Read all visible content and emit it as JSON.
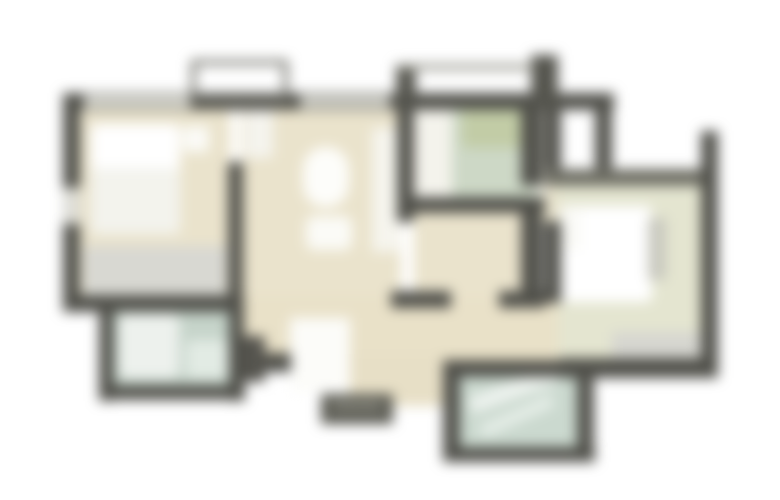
{
  "meta": {
    "description": "Blurred apartment floor plan, no readable text",
    "canvas": {
      "width": 780,
      "height": 500,
      "background": "#ffffff"
    },
    "blur_px": 6.5
  },
  "palette": {
    "wall_dark": "#50504a",
    "wall_light_window": "#d8d8d0",
    "floor_beige": "#eae3cc",
    "floor_pale_green": "#e4e5d0",
    "tile_green": "#cbd9cf",
    "shower_green": "#c2cca6",
    "furniture_white": "#ffffff",
    "furniture_gray": "#d8d8d2",
    "porch_gray": "#5a5a52"
  },
  "floorplan": {
    "rects": [
      {
        "name": "left-bedroom-floor",
        "x": 78,
        "y": 104,
        "w": 152,
        "h": 198,
        "fill": "#eae3cc"
      },
      {
        "name": "living-room-floor",
        "x": 241,
        "y": 104,
        "w": 160,
        "h": 256,
        "fill": "#eae3cc"
      },
      {
        "name": "hall-floor",
        "x": 241,
        "y": 296,
        "w": 380,
        "h": 64,
        "fill": "#e9e1c8"
      },
      {
        "name": "corridor-floor",
        "x": 414,
        "y": 212,
        "w": 112,
        "h": 86,
        "fill": "#eae3cc"
      },
      {
        "name": "right-door-opening-floor",
        "x": 540,
        "y": 186,
        "w": 22,
        "h": 38,
        "fill": "#e8e2cc"
      },
      {
        "name": "mid-bathroom-floor",
        "x": 414,
        "y": 106,
        "w": 130,
        "h": 100,
        "fill": "#f4f3ec"
      },
      {
        "name": "mid-bathroom-tiles",
        "x": 452,
        "y": 104,
        "w": 84,
        "h": 100,
        "fill": "#cdd8c6"
      },
      {
        "name": "mid-bathroom-shower",
        "x": 462,
        "y": 98,
        "w": 70,
        "h": 50,
        "fill": "#c2cca6",
        "radius": 6
      },
      {
        "name": "right-bedroom-floor",
        "x": 558,
        "y": 182,
        "w": 146,
        "h": 176,
        "fill": "#e4e5d0"
      },
      {
        "name": "left-bathroom-tiles",
        "x": 110,
        "y": 306,
        "w": 124,
        "h": 86,
        "fill": "#c6d4ca"
      },
      {
        "name": "bottom-bathroom-tiles",
        "x": 458,
        "y": 374,
        "w": 124,
        "h": 78,
        "fill": "#cbd9cf"
      },
      {
        "name": "vestibule-floor",
        "x": 348,
        "y": 354,
        "w": 102,
        "h": 52,
        "fill": "#e7dfc6"
      },
      {
        "name": "left-bed",
        "x": 91,
        "y": 124,
        "w": 89,
        "h": 110,
        "fill": "#ffffff",
        "radius": 6
      },
      {
        "name": "left-bed-blanket",
        "x": 91,
        "y": 168,
        "w": 89,
        "h": 66,
        "fill": "#f3f3ed",
        "radius": 4
      },
      {
        "name": "left-nightstand",
        "x": 183,
        "y": 126,
        "w": 26,
        "h": 26,
        "fill": "#fbfbf7"
      },
      {
        "name": "left-wardrobe",
        "x": 84,
        "y": 246,
        "w": 142,
        "h": 50,
        "fill": "#d8d8d2"
      },
      {
        "name": "living-table",
        "x": 303,
        "y": 147,
        "w": 46,
        "h": 60,
        "fill": "#fdfdfa",
        "radius": 22
      },
      {
        "name": "living-chair-group",
        "x": 306,
        "y": 216,
        "w": 46,
        "h": 34,
        "fill": "#fbfbf7",
        "radius": 8
      },
      {
        "name": "living-door-swing-white",
        "x": 245,
        "y": 106,
        "w": 28,
        "h": 52,
        "fill": "#f5f4ee"
      },
      {
        "name": "kitchen-counter-strip",
        "x": 372,
        "y": 128,
        "w": 28,
        "h": 124,
        "fill": "#f6f5ee"
      },
      {
        "name": "right-bed",
        "x": 560,
        "y": 206,
        "w": 92,
        "h": 96,
        "fill": "#ffffff",
        "radius": 6
      },
      {
        "name": "right-bed-pillow",
        "x": 561,
        "y": 210,
        "w": 20,
        "h": 40,
        "fill": "#fafaf6"
      },
      {
        "name": "right-bedside-unit",
        "x": 648,
        "y": 218,
        "w": 18,
        "h": 62,
        "fill": "#c9c9bf"
      },
      {
        "name": "right-wardrobe",
        "x": 612,
        "y": 332,
        "w": 92,
        "h": 28,
        "fill": "#d6d6d0"
      },
      {
        "name": "left-bathtub",
        "x": 119,
        "y": 314,
        "w": 60,
        "h": 64,
        "fill": "#edf1ed",
        "radius": 8
      },
      {
        "name": "left-bathroom-sink",
        "x": 186,
        "y": 340,
        "w": 42,
        "h": 38,
        "fill": "#e2ebe4",
        "radius": 6
      },
      {
        "name": "bottom-bath-fixture-1",
        "x": 468,
        "y": 382,
        "w": 92,
        "h": 16,
        "fill": "#eef3ef",
        "rotate": -20
      },
      {
        "name": "bottom-bath-fixture-2",
        "x": 478,
        "y": 410,
        "w": 78,
        "h": 12,
        "fill": "#e7efe9",
        "rotate": -24
      },
      {
        "name": "entry-door-white",
        "x": 290,
        "y": 318,
        "w": 60,
        "h": 74,
        "fill": "#fcfcf9"
      },
      {
        "name": "top-wall",
        "x": 63,
        "y": 93,
        "w": 551,
        "h": 17,
        "fill": "#50504a"
      },
      {
        "name": "top-window-left",
        "x": 84,
        "y": 95,
        "w": 106,
        "h": 13,
        "fill": "#d8d8d0"
      },
      {
        "name": "top-window-mid",
        "x": 300,
        "y": 95,
        "w": 90,
        "h": 13,
        "fill": "#cfcfc7"
      },
      {
        "name": "left-outer-wall",
        "x": 63,
        "y": 93,
        "w": 17,
        "h": 219,
        "fill": "#50504a"
      },
      {
        "name": "left-wall-window",
        "x": 63,
        "y": 188,
        "w": 17,
        "h": 36,
        "fill": "#dcdcd6"
      },
      {
        "name": "left-bedroom-bottom-wall",
        "x": 63,
        "y": 295,
        "w": 181,
        "h": 17,
        "fill": "#50504a"
      },
      {
        "name": "bedroom-living-divider",
        "x": 228,
        "y": 162,
        "w": 15,
        "h": 150,
        "fill": "#50504a"
      },
      {
        "name": "mid-left-wall-upper",
        "x": 397,
        "y": 104,
        "w": 17,
        "h": 118,
        "fill": "#50504a"
      },
      {
        "name": "mid-left-wall-stub",
        "x": 391,
        "y": 291,
        "w": 60,
        "h": 17,
        "fill": "#50504a"
      },
      {
        "name": "mid-bath-bottom-wall",
        "x": 414,
        "y": 197,
        "w": 131,
        "h": 16,
        "fill": "#50504a"
      },
      {
        "name": "mid-right-wall-upper",
        "x": 521,
        "y": 93,
        "w": 21,
        "h": 93,
        "fill": "#50504a"
      },
      {
        "name": "mid-right-wall-lower",
        "x": 521,
        "y": 211,
        "w": 21,
        "h": 83,
        "fill": "#50504a"
      },
      {
        "name": "corridor-right-stub",
        "x": 499,
        "y": 291,
        "w": 46,
        "h": 17,
        "fill": "#50504a"
      },
      {
        "name": "shaft-left-wall",
        "x": 544,
        "y": 93,
        "w": 17,
        "h": 91,
        "fill": "#50504a"
      },
      {
        "name": "shaft-right-wall",
        "x": 595,
        "y": 93,
        "w": 17,
        "h": 91,
        "fill": "#50504a"
      },
      {
        "name": "right-bedroom-top-wall",
        "x": 544,
        "y": 169,
        "w": 161,
        "h": 17,
        "fill": "#6e6e64"
      },
      {
        "name": "right-bedroom-left-wall",
        "x": 544,
        "y": 221,
        "w": 17,
        "h": 82,
        "fill": "#50504a"
      },
      {
        "name": "right-outer-wall",
        "x": 701,
        "y": 131,
        "w": 17,
        "h": 241,
        "fill": "#50504a"
      },
      {
        "name": "right-bottom-wall",
        "x": 560,
        "y": 358,
        "w": 158,
        "h": 20,
        "fill": "#50504a"
      },
      {
        "name": "hall-bottom-wall",
        "x": 239,
        "y": 353,
        "w": 52,
        "h": 19,
        "fill": "#50504a"
      },
      {
        "name": "hall-corner-wall",
        "x": 239,
        "y": 336,
        "w": 26,
        "h": 46,
        "fill": "#55544e"
      },
      {
        "name": "left-bath-left-wall",
        "x": 99,
        "y": 303,
        "w": 15,
        "h": 98,
        "fill": "#50504a"
      },
      {
        "name": "left-bath-bottom-wall",
        "x": 99,
        "y": 385,
        "w": 146,
        "h": 15,
        "fill": "#50504a"
      },
      {
        "name": "left-bath-right-wall",
        "x": 229,
        "y": 303,
        "w": 15,
        "h": 98,
        "fill": "#50504a"
      },
      {
        "name": "bottom-bath-left-wall",
        "x": 443,
        "y": 360,
        "w": 17,
        "h": 102,
        "fill": "#50504a"
      },
      {
        "name": "bottom-bath-top-wall",
        "x": 443,
        "y": 360,
        "w": 152,
        "h": 17,
        "fill": "#50504a"
      },
      {
        "name": "bottom-bath-right-wall",
        "x": 577,
        "y": 360,
        "w": 17,
        "h": 102,
        "fill": "#50504a"
      },
      {
        "name": "bottom-bath-bottom-wall",
        "x": 443,
        "y": 447,
        "w": 152,
        "h": 15,
        "fill": "#50504a"
      },
      {
        "name": "entry-porch-steps",
        "x": 321,
        "y": 394,
        "w": 72,
        "h": 30,
        "fill": "#5a5a52"
      },
      {
        "name": "entry-porch-step-light",
        "x": 332,
        "y": 402,
        "w": 50,
        "h": 8,
        "fill": "#8a8a80"
      },
      {
        "name": "balcony-outline",
        "x": 191,
        "y": 60,
        "w": 97,
        "h": 42,
        "fill": "transparent",
        "border": "5px solid #6e6e66"
      },
      {
        "name": "balcony2-left-post",
        "x": 396,
        "y": 64,
        "w": 20,
        "h": 44,
        "fill": "#55554e"
      },
      {
        "name": "balcony2-right-post",
        "x": 531,
        "y": 55,
        "w": 27,
        "h": 53,
        "fill": "#55554e"
      },
      {
        "name": "balcony2-rail",
        "x": 398,
        "y": 64,
        "w": 136,
        "h": 6,
        "fill": "#98988e"
      }
    ]
  }
}
